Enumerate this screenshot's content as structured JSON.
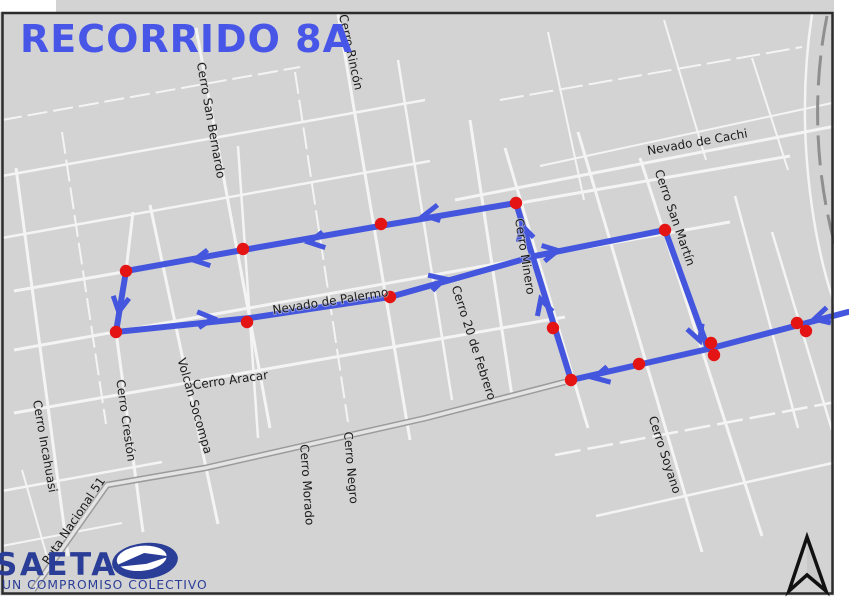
{
  "title": "RECORRIDO 8A",
  "logo": {
    "name": "SAETA",
    "tagline": "UN COMPROMISO COLECTIVO"
  },
  "icons": {
    "north_arrow": "north-pointer",
    "logo_emblem": "saeta-dart-ellipse"
  },
  "colors": {
    "map_bg": "#d3d3d3",
    "street": "#f4f4f4",
    "route": "#4456dd",
    "stop": "#e41414",
    "title": "#4856e8",
    "logo": "#2b3e97",
    "frame": "#2c2c2c",
    "highway_casing": "#9b9b9b",
    "highway_fill": "#e4e4e4",
    "rail": "#8f8f8f",
    "label": "#1b1b1b"
  },
  "streets": [
    {
      "pts": "2,120 300,67",
      "w": 2,
      "dash": "20 6"
    },
    {
      "pts": "2,176 425,100",
      "w": 2.5
    },
    {
      "pts": "2,238 430,161",
      "w": 2.5
    },
    {
      "pts": "14,291 790,156",
      "w": 3
    },
    {
      "pts": "455,200 846,124",
      "w": 3
    },
    {
      "pts": "14,350 730,222",
      "w": 3
    },
    {
      "pts": "14,413 565,317",
      "w": 3
    },
    {
      "pts": "555,455 846,400",
      "w": 2.5,
      "dash": "26 7"
    },
    {
      "pts": "596,516 846,460",
      "w": 2.5
    },
    {
      "pts": "2,491 162,462",
      "w": 2.5
    },
    {
      "pts": "2,546 122,523",
      "w": 2
    },
    {
      "pts": "500,100 802,47",
      "w": 2,
      "dash": "24 6"
    },
    {
      "pts": "540,166 832,103",
      "w": 2
    },
    {
      "pts": "16,168 68,556",
      "w": 3
    },
    {
      "pts": "62,132 106,424",
      "w": 2,
      "dash": "22 6"
    },
    {
      "pts": "133,212 126,271 116,332 143,532",
      "w": 3
    },
    {
      "pts": "150,205 218,524",
      "w": 3
    },
    {
      "pts": "196,28 270,428",
      "w": 3
    },
    {
      "pts": "238,146 258,438",
      "w": 2.5
    },
    {
      "pts": "295,72 348,422",
      "w": 2,
      "dash": "22 6"
    },
    {
      "pts": "338,14 410,440",
      "w": 3
    },
    {
      "pts": "398,60 452,400",
      "w": 2.5
    },
    {
      "pts": "470,120 512,396",
      "w": 3
    },
    {
      "pts": "505,148 588,428",
      "w": 3
    },
    {
      "pts": "578,132 702,552",
      "w": 3
    },
    {
      "pts": "640,158 762,536",
      "w": 3
    },
    {
      "pts": "735,196 798,428",
      "w": 2.5
    },
    {
      "pts": "772,232 832,430",
      "w": 2.5
    },
    {
      "pts": "548,32 584,200",
      "w": 2
    },
    {
      "pts": "664,20 706,160",
      "w": 2
    },
    {
      "pts": "752,58 788,170",
      "w": 2
    },
    {
      "pts": "22,470 48,560",
      "w": 2
    },
    {
      "pts": "565,382 710,349 848,313",
      "w": 4
    }
  ],
  "highway": {
    "pts": "33,590 107,485 205,468 426,418 565,382"
  },
  "rail_path": "M827,16 C812,90 814,180 840,262",
  "curve_road": "M812,14 Q796,120 816,232 Q828,296 846,330",
  "street_labels": [
    {
      "text": "Cerro San Bernardo",
      "x": 207,
      "y": 121,
      "r": 80
    },
    {
      "text": "Cerro Rincón",
      "x": 347,
      "y": 53,
      "r": 78
    },
    {
      "text": "Nevado de Cachi",
      "x": 698,
      "y": 146,
      "r": -10
    },
    {
      "text": "Cerro San Martín",
      "x": 671,
      "y": 219,
      "r": 71
    },
    {
      "text": "Cerro Minero",
      "x": 521,
      "y": 257,
      "r": 81
    },
    {
      "text": "Nevado de Palermo",
      "x": 331,
      "y": 305,
      "r": -9
    },
    {
      "text": "Cerro 20 de Febrero",
      "x": 470,
      "y": 344,
      "r": 72
    },
    {
      "text": "Volcán Socompa",
      "x": 191,
      "y": 407,
      "r": 74
    },
    {
      "text": "Cerro Aracar",
      "x": 231,
      "y": 384,
      "r": -8
    },
    {
      "text": "Cerro Crestón",
      "x": 122,
      "y": 421,
      "r": 82
    },
    {
      "text": "Cerro Incahuasi",
      "x": 41,
      "y": 447,
      "r": 80
    },
    {
      "text": "Ruta Nacional 51",
      "x": 77,
      "y": 523,
      "r": -56
    },
    {
      "text": "Cerro Negro",
      "x": 347,
      "y": 468,
      "r": 85
    },
    {
      "text": "Cerro Morado",
      "x": 303,
      "y": 485,
      "r": 86
    },
    {
      "text": "Cerro Soyano",
      "x": 661,
      "y": 456,
      "r": 72
    }
  ],
  "route": {
    "lines": [
      "848,312 708,349 571,380 516,203",
      "516,203 380,226 243,250 126,271 116,332 250,318 390,297 535,256 665,230 708,349"
    ],
    "stops": [
      [
        126,
        271
      ],
      [
        116,
        332
      ],
      [
        243,
        249
      ],
      [
        381,
        224
      ],
      [
        516,
        203
      ],
      [
        247,
        322
      ],
      [
        390,
        297
      ],
      [
        665,
        230
      ],
      [
        553,
        328
      ],
      [
        571,
        380
      ],
      [
        639,
        364
      ],
      [
        711,
        343
      ],
      [
        714,
        355
      ],
      [
        797,
        323
      ],
      [
        806,
        331
      ]
    ],
    "arrows": [
      [
        432,
        214,
        170
      ],
      [
        317,
        241,
        170
      ],
      [
        202,
        259,
        170
      ],
      [
        120,
        304,
        99
      ],
      [
        205,
        319,
        -6
      ],
      [
        437,
        281,
        -16
      ],
      [
        550,
        252,
        -11
      ],
      [
        697,
        333,
        70
      ],
      [
        822,
        317,
        165
      ],
      [
        602,
        376,
        167
      ],
      [
        543,
        307,
        -107
      ],
      [
        524,
        233,
        -107
      ]
    ]
  }
}
